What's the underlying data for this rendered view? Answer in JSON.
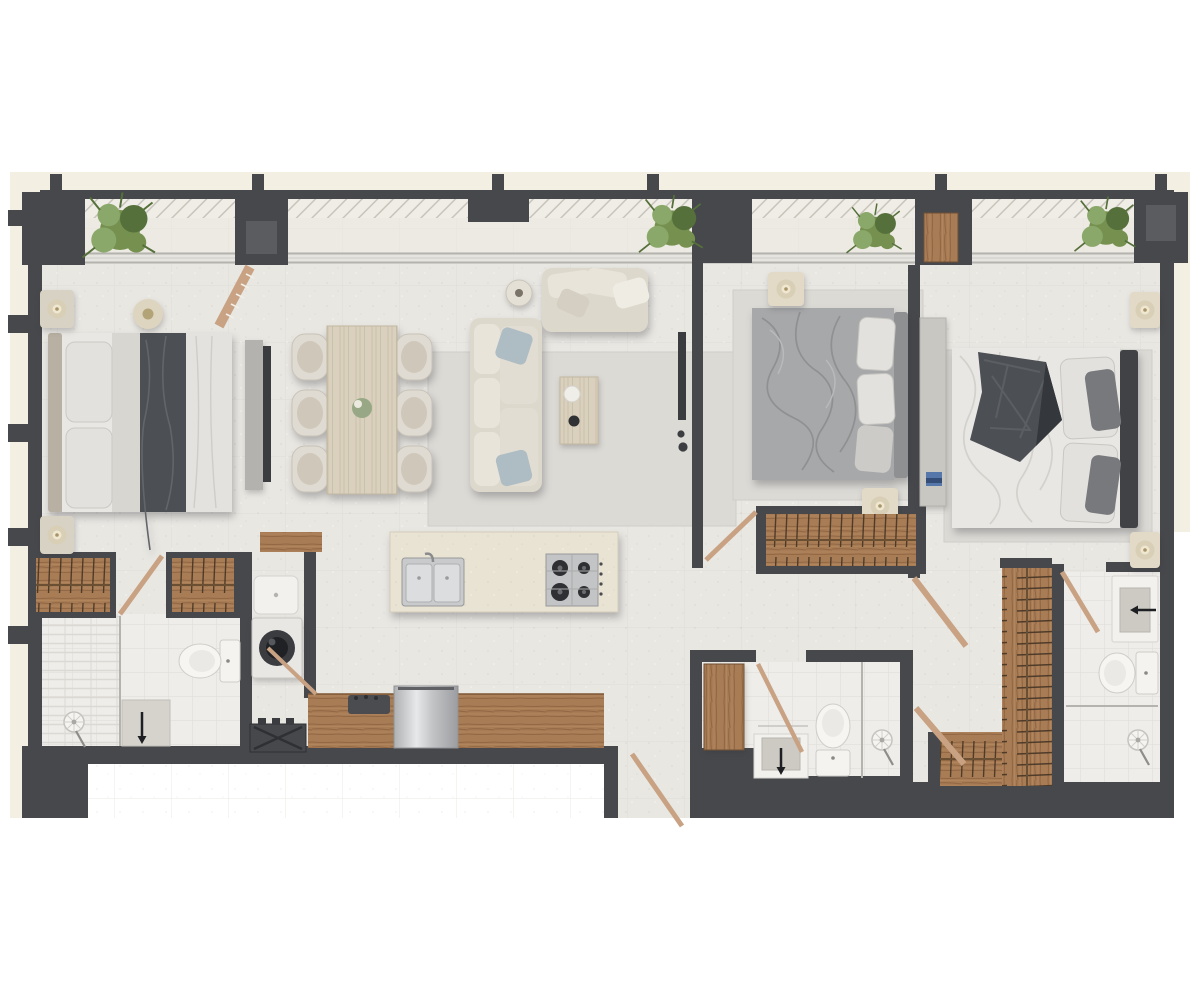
{
  "canvas": {
    "width": 1200,
    "height": 1000,
    "background_hex": "#ffffff"
  },
  "image_type": "apartment-floor-plan-top-down-render",
  "text_content": [],
  "palette": {
    "wall": "#46484c",
    "wall_inner": "#5a5c60",
    "plot": "#f4efe3",
    "floor": "#e9e7e2",
    "tile_line": "#d7d5d0",
    "bath": "#efede9",
    "balcony": "#edeae3",
    "rug": "#dcdad5",
    "wood": "#a87c55",
    "wood_dark": "#8a6240",
    "wood_light": "#d9d0bd",
    "marble": "#e9e3d4",
    "steel": "#c6c7c9",
    "steel_dark": "#97989a",
    "fabric": "#ddd8cc",
    "fabric_light": "#e8e4da",
    "white_fix": "#f4f3f0",
    "bed_white": "#e9e7e3",
    "bed_gray": "#a7a8aa",
    "bed_gray_dark": "#8f9092",
    "blanket": "#4c4f53",
    "pillow": "#e3e1dd",
    "accent": "#aebcc3",
    "plant": "#76914f",
    "plant_light": "#8aa86a",
    "plant_dark": "#55703a",
    "glass": "#b5b3ae",
    "lamp": "#d8cfb6",
    "burner": "#2e3033",
    "dark_item": "#3c3e42",
    "door_wood": "#c8a283"
  },
  "structure": {
    "exterior_columns": 6,
    "window_wall": "continuous glazing along top between columns",
    "balcony": "hatched strip along full top edge with 4 plants"
  },
  "rooms": [
    {
      "name": "balcony",
      "furniture": [
        "plant",
        "plant",
        "plant",
        "plant",
        "louvered-door",
        "wood-door-panel"
      ]
    },
    {
      "name": "bedroom-1",
      "furniture": [
        "double-bed",
        "nightstand",
        "nightstand",
        "floor-lamp",
        "tv-console",
        "tv",
        "wardrobe",
        "wardrobe",
        "door"
      ]
    },
    {
      "name": "living-dining",
      "furniture": [
        "dining-table",
        "dining-chair",
        "dining-chair",
        "dining-chair",
        "dining-chair",
        "dining-chair",
        "dining-chair",
        "l-sofa",
        "loveseat",
        "side-table",
        "coffee-table",
        "rug",
        "floor-lamp",
        "tv"
      ]
    },
    {
      "name": "kitchen",
      "furniture": [
        "island-with-sink-and-hob",
        "wood-counter",
        "fridge",
        "coffee-machine",
        "utility-box",
        "entry-door"
      ]
    },
    {
      "name": "laundry",
      "furniture": [
        "laundry-sink",
        "washing-machine",
        "door"
      ]
    },
    {
      "name": "bathroom-1",
      "furniture": [
        "shower",
        "shower-head",
        "vanity-sink",
        "toilet"
      ]
    },
    {
      "name": "bedroom-2",
      "furniture": [
        "double-bed",
        "nightstand",
        "nightstand",
        "open-closet",
        "rug",
        "door"
      ]
    },
    {
      "name": "bathroom-2",
      "furniture": [
        "wood-cabinet",
        "vanity-sink",
        "toilet",
        "shower",
        "shower-head",
        "door"
      ]
    },
    {
      "name": "bedroom-3",
      "furniture": [
        "double-bed",
        "nightstand",
        "nightstand",
        "dresser",
        "rug",
        "door"
      ]
    },
    {
      "name": "walk-in-closet",
      "furniture": [
        "l-shaped-wardrobe",
        "door",
        "door"
      ]
    },
    {
      "name": "bathroom-3",
      "furniture": [
        "vanity-sink",
        "toilet",
        "shower",
        "shower-head",
        "door"
      ]
    }
  ]
}
